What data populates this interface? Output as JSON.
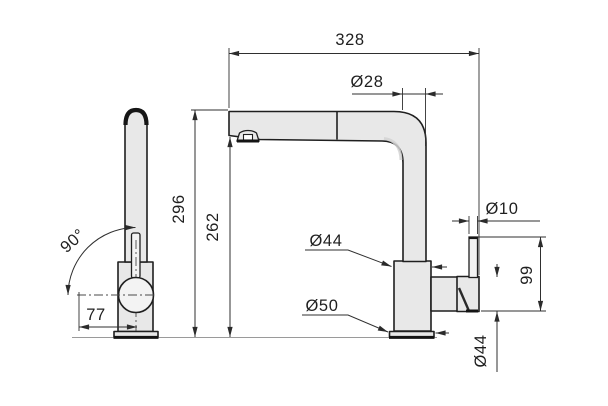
{
  "diagram": {
    "type": "technical_dimension_drawing",
    "description": "Two-view dimensioned drawing of a single-lever kitchen mixer tap with high L-shaped swivel spout: side view (left) and front view (right)",
    "colors": {
      "background": "#ffffff",
      "line": "#1f1f1f",
      "dim_line": "#2f2f2f",
      "fill": "#e8e8e8",
      "fill_light": "#f3f3f3",
      "deck_line": "#9a9a9a"
    },
    "labels": {
      "overall_projection": "328",
      "spout_tube_diameter": "Ø28",
      "total_height": "296",
      "outlet_height": "262",
      "swivel_angle": "90°",
      "outlet_offset": "77",
      "body_diameter": "Ø44",
      "base_diameter": "Ø50",
      "lever_rod_diameter": "Ø10",
      "lever_assembly_height": "99",
      "lever_body_diameter": "Ø44"
    }
  }
}
